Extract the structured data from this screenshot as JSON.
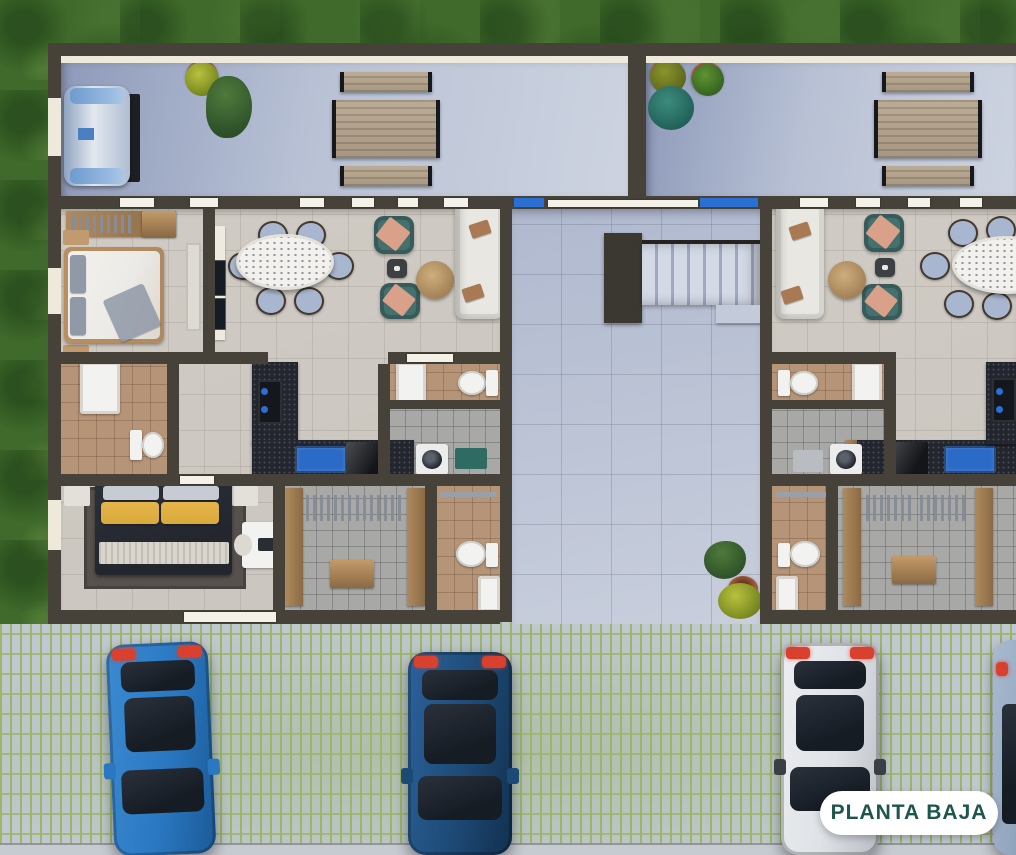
{
  "label": {
    "text": "PLANTA BAJA"
  },
  "palette": {
    "grass": "#3f6a2b",
    "wall": "#46423a",
    "wall-face": "#efe9dc",
    "patio-a": "#8e9aba",
    "patio-b": "#cdd3e0",
    "interior-floor": "#cac5be",
    "bath-floor": "#b59478",
    "utility-floor": "#a8a8a6",
    "courtyard-a": "#b0b9cf",
    "courtyard-b": "#c8cedc",
    "paver-base": "#c2cad7",
    "paver-joint": "#9db469",
    "curb": "#c6cad1",
    "counter-dark": "#23262e",
    "sink-blue": "#2b6ac6",
    "accent-blue": "#2a6fd2",
    "wood": "#b08a5e",
    "wood-dark": "#8a6a44",
    "outdoor-wood": "#bdac95",
    "frame-black": "#17181c",
    "sofa-white": "#e9e7e1",
    "armchair-teal": "#44706e",
    "cushion-salmon": "#d9a18a",
    "cushion-brown": "#a97954",
    "marble": "#f2f1ee",
    "chair-seat": "#a9b6cf",
    "bed-white": "#eceae6",
    "pillow-grey": "#9099a8",
    "bed-dark": "#23262d",
    "pillow-yellow": "#d9a93c",
    "rug": "#57514d",
    "stair-landing": "#3b3831",
    "stair-light": "#d3d9e5",
    "stair-dark": "#9fa9c0",
    "pot": "#a05a36",
    "white-fixture": "#f2f2f0",
    "car-blue": "#2a78c2",
    "car-navy": "#1d4a75",
    "car-silver": "#dfe2e6",
    "car-partial": "#8fa3bb",
    "glass": "#161c24",
    "taillight": "#d9402e",
    "label-bg": "#ffffff",
    "label-text": "#1d564c"
  },
  "scene": {
    "description": "Top-down 3D architectural render of a mirrored two-unit ground floor with rear terraces, central stair courtyard and front grass-paver parking",
    "left_unit": {
      "rooms": [
        "terrace",
        "bedroom",
        "dining-room",
        "living-room",
        "kitchen",
        "bathroom",
        "laundry",
        "walk-in-closet",
        "ensuite-bathroom",
        "master-bedroom"
      ],
      "furniture": [
        "bbq-grill",
        "outdoor-table-with-benches",
        "potted-plants",
        "wardrobe-closet",
        "double-bed",
        "nightstands",
        "oval-marble-dining-table",
        "six-dining-chairs",
        "two-teal-armchairs",
        "round-wood-coffee-table",
        "dark-side-table",
        "white-l-sofa",
        "oven-column",
        "l-shaped-dark-counter",
        "blue-kitchen-sink",
        "stove",
        "refrigerator",
        "washing-machine",
        "toilets",
        "vanity-sinks",
        "closet-shelving-with-hangers",
        "dresser",
        "master-bed-with-yellow-pillows",
        "foot-bench",
        "desk-with-chair",
        "area-rug",
        "shower"
      ]
    },
    "right_unit": {
      "note": "mirrored copy of left unit, partially cut off at right edge of image",
      "furniture": [
        "outdoor-table-with-benches",
        "potted-plants",
        "white-l-sofa",
        "two-teal-armchairs",
        "round-wood-coffee-table",
        "dark-side-table",
        "oval-marble-dining-table",
        "dining-chairs",
        "dark-counter",
        "blue-kitchen-sink",
        "refrigerator",
        "stove",
        "washing-machine",
        "toilets",
        "vanity-sinks",
        "closet-shelving-with-hangers",
        "dresser",
        "shower"
      ]
    },
    "courtyard": {
      "features": [
        "concrete-staircase",
        "dark-stair-landing",
        "stair-railing",
        "potted-plants"
      ]
    },
    "parking": {
      "surface": "grass-joint paver blocks",
      "cars": [
        {
          "name": "car-blue",
          "color": "#2a78c2"
        },
        {
          "name": "car-navy",
          "color": "#1d4a75"
        },
        {
          "name": "car-silver",
          "color": "#dfe2e6"
        },
        {
          "name": "car-partial-right-edge",
          "color": "#8fa3bb"
        }
      ]
    }
  }
}
